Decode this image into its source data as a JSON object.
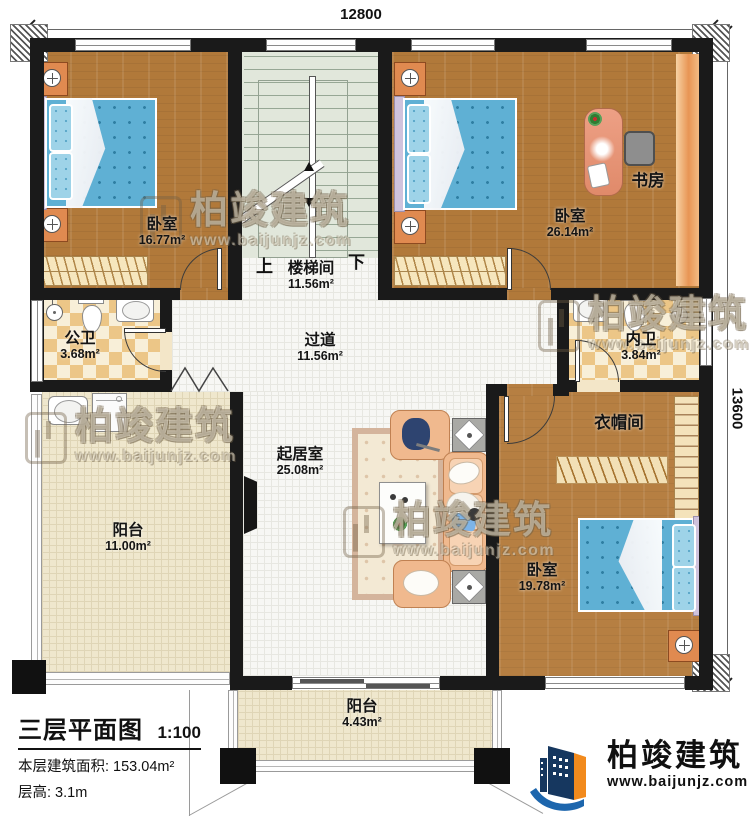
{
  "dims": {
    "top": "12800",
    "right": "13600"
  },
  "stairs": {
    "up": "上",
    "down": "下"
  },
  "rooms": {
    "bedroom1": {
      "name": "卧室",
      "area": "16.77m²"
    },
    "stairwell": {
      "name": "楼梯间",
      "area": "11.56m²"
    },
    "bedroom2": {
      "name": "卧室",
      "area": "26.14m²"
    },
    "study": {
      "name": "书房"
    },
    "bath_public": {
      "name": "公卫",
      "area": "3.68m²"
    },
    "corridor": {
      "name": "过道",
      "area": "11.56m²"
    },
    "bath_private": {
      "name": "内卫",
      "area": "3.84m²"
    },
    "cloakroom": {
      "name": "衣帽间"
    },
    "living": {
      "name": "起居室",
      "area": "25.08m²"
    },
    "balcony_left": {
      "name": "阳台",
      "area": "11.00m²"
    },
    "bedroom3": {
      "name": "卧室",
      "area": "19.78m²"
    },
    "balcony_bottom": {
      "name": "阳台",
      "area": "4.43m²"
    }
  },
  "title_block": {
    "title": "三层平面图",
    "scale": "1:100",
    "area_line": "本层建筑面积: 153.04m²",
    "height_line": "层高: 3.1m"
  },
  "brand": {
    "name": "柏竣建筑",
    "site": "www.baijunjz.com"
  },
  "palette": {
    "wall": "#1a1a1a",
    "wood": "#b1793a",
    "bed": "#5fb0d4",
    "checker": "#ecc687",
    "sofa": "#f0b98e",
    "balcony": "#efe7cd",
    "stair": "#e1e7db",
    "logo_blue": "#1d66ad",
    "logo_orange": "#f28a1d"
  }
}
